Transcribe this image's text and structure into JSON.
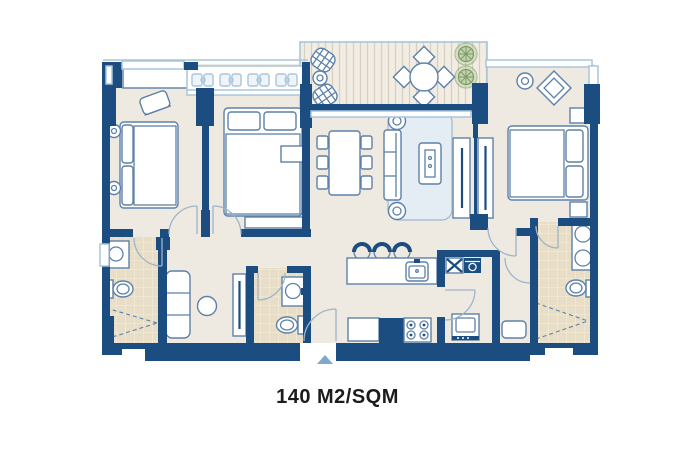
{
  "caption": {
    "area_label": "140 M2/SQM"
  },
  "colors": {
    "background": "#ffffff",
    "wall": "#1b4d80",
    "wall_light": "#a9c5db",
    "floor": "#efeae1",
    "tile": "#e8ddc6",
    "tile_grid": "#f6eeda",
    "deck": "#f2ede3",
    "deck_stripe": "#d7d0c2",
    "furn_stroke": "#5d81a8",
    "furn_fill": "#ffffff",
    "furn_soft": "#e5edf4",
    "rug_stroke": "#9fb8cf",
    "plant": "#7d9c64",
    "plant_soft": "#c2d1b0",
    "marker": "#7fa8cc",
    "door": "#9db4c9",
    "caption_text": "#1c1c1e"
  }
}
